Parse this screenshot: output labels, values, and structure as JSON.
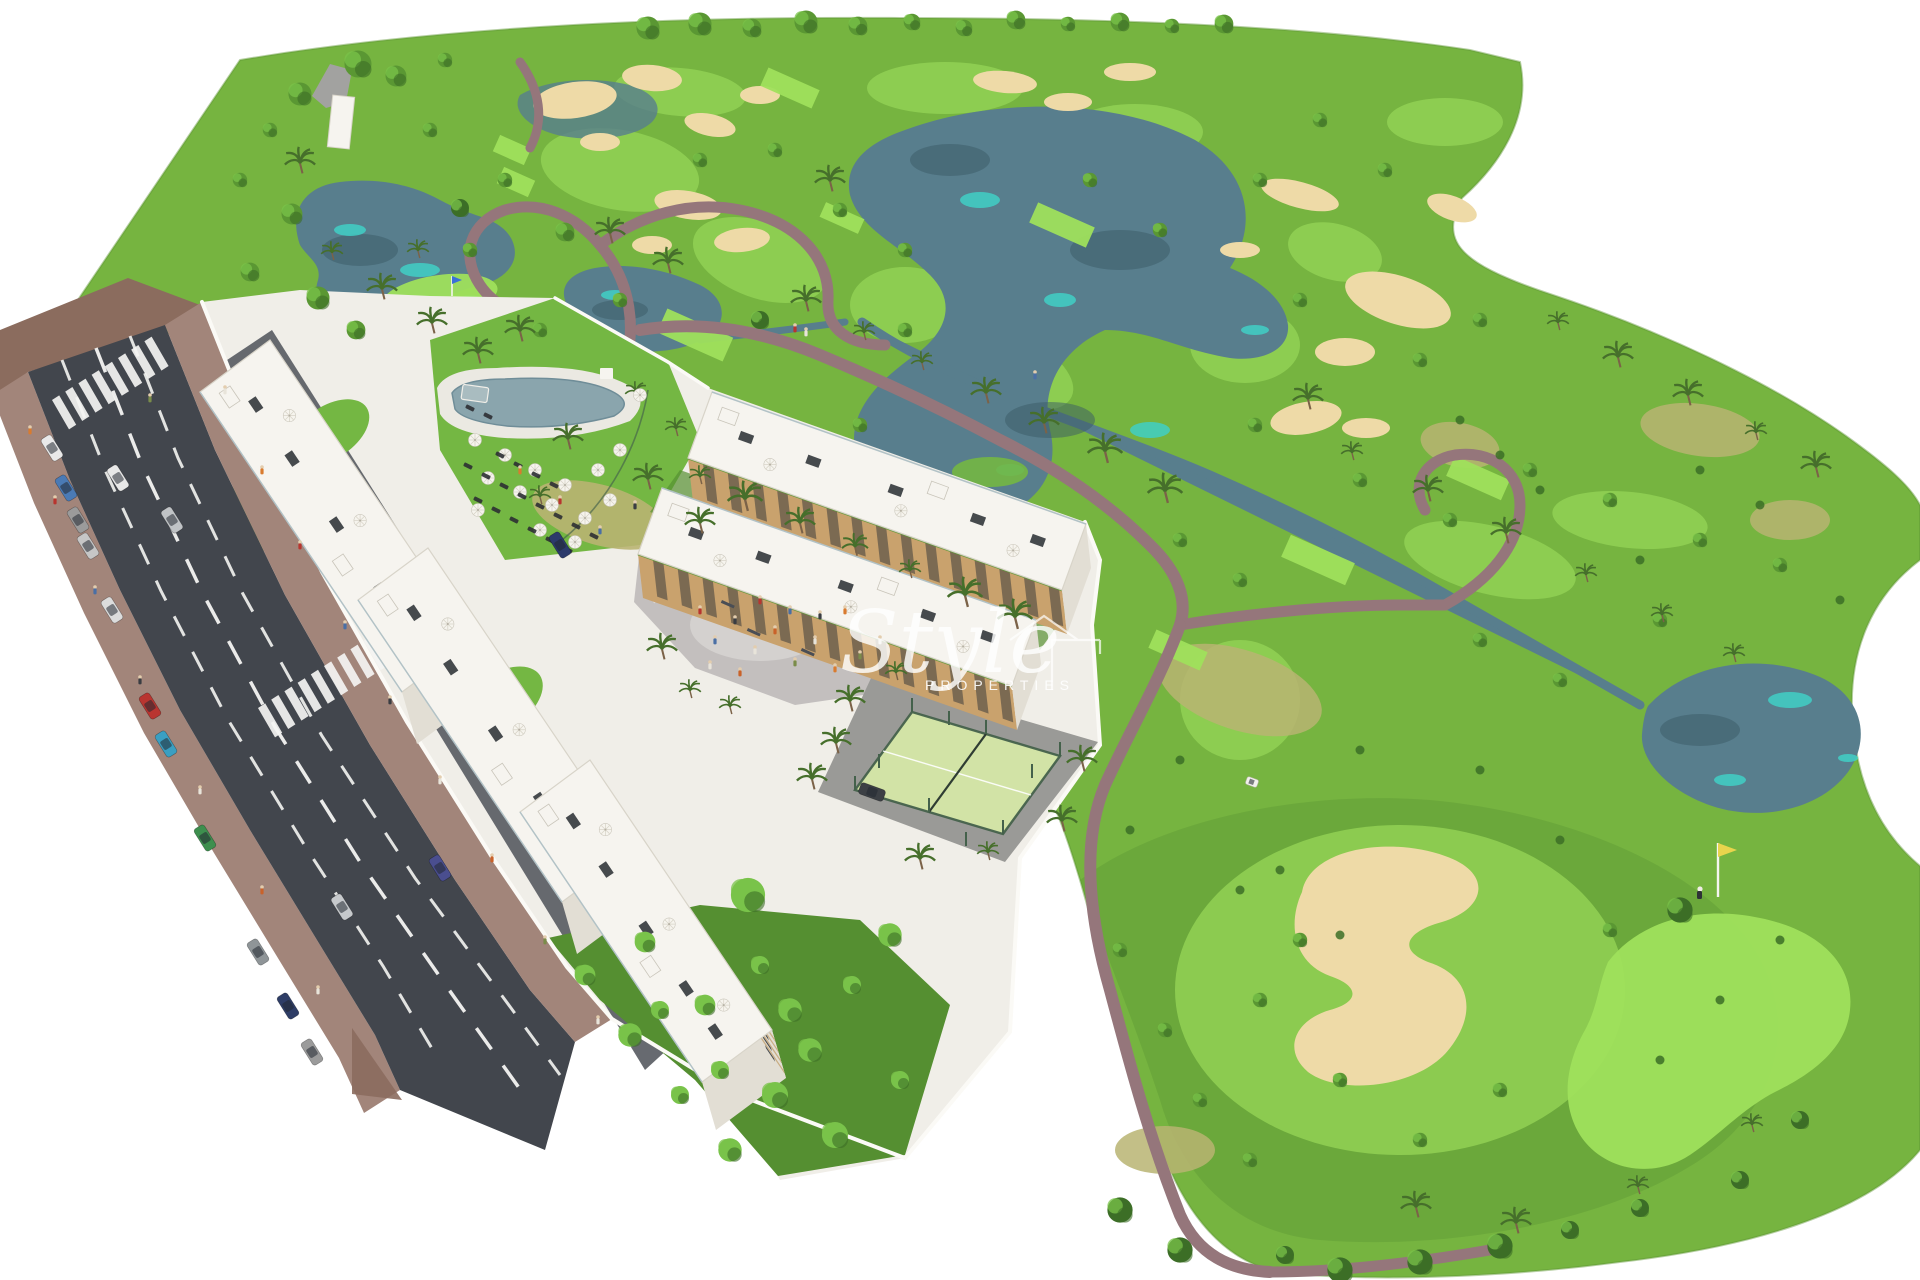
{
  "watermark": {
    "brand": "Style",
    "subtitle": "PROPERTIES"
  },
  "palette": {
    "bg": "#ffffff",
    "rough": "#76b440",
    "rough_dark": "#639f36",
    "fairway": "#92d155",
    "green_bright": "#9fe05c",
    "lawn": "#74b743",
    "dry_grass": "#b9b472",
    "water": "#587e8d",
    "water_dark": "#3a5a66",
    "water_teal": "#41cfc6",
    "sand": "#eedaa7",
    "rock": "#a2a2a0",
    "path": "#95767b",
    "asphalt": "#42464d",
    "asphalt_light": "#565a61",
    "sidewalk": "#a2857a",
    "sidewalk_dark": "#8b6c5e",
    "lane": "#f4f4f2",
    "dev_ground": "#f0eee8",
    "building": "#f6f4ef",
    "building_shade": "#e2ded4",
    "band": "#c9ad83",
    "wood": "#c9a26d",
    "window": "#2e3237",
    "wall": "#fbfaf6",
    "court": "#d2e3a6",
    "court_fence": "#44614b",
    "apron": "#9a9a97",
    "plaza": "#c3bfbe",
    "plaza_light": "#d4d1cf",
    "tree_dark": "#3c6e27",
    "tree_mid": "#5a9733",
    "tree_bright": "#79c34a",
    "palm": "#466f2b",
    "trunk": "#7b6248",
    "umbrella": "#f6f4ee",
    "lounger": "#2c2f33",
    "pool_deck": "#ebe9e2",
    "pool_water": "#8aa5ad",
    "flag_yellow": "#e8d44d"
  }
}
